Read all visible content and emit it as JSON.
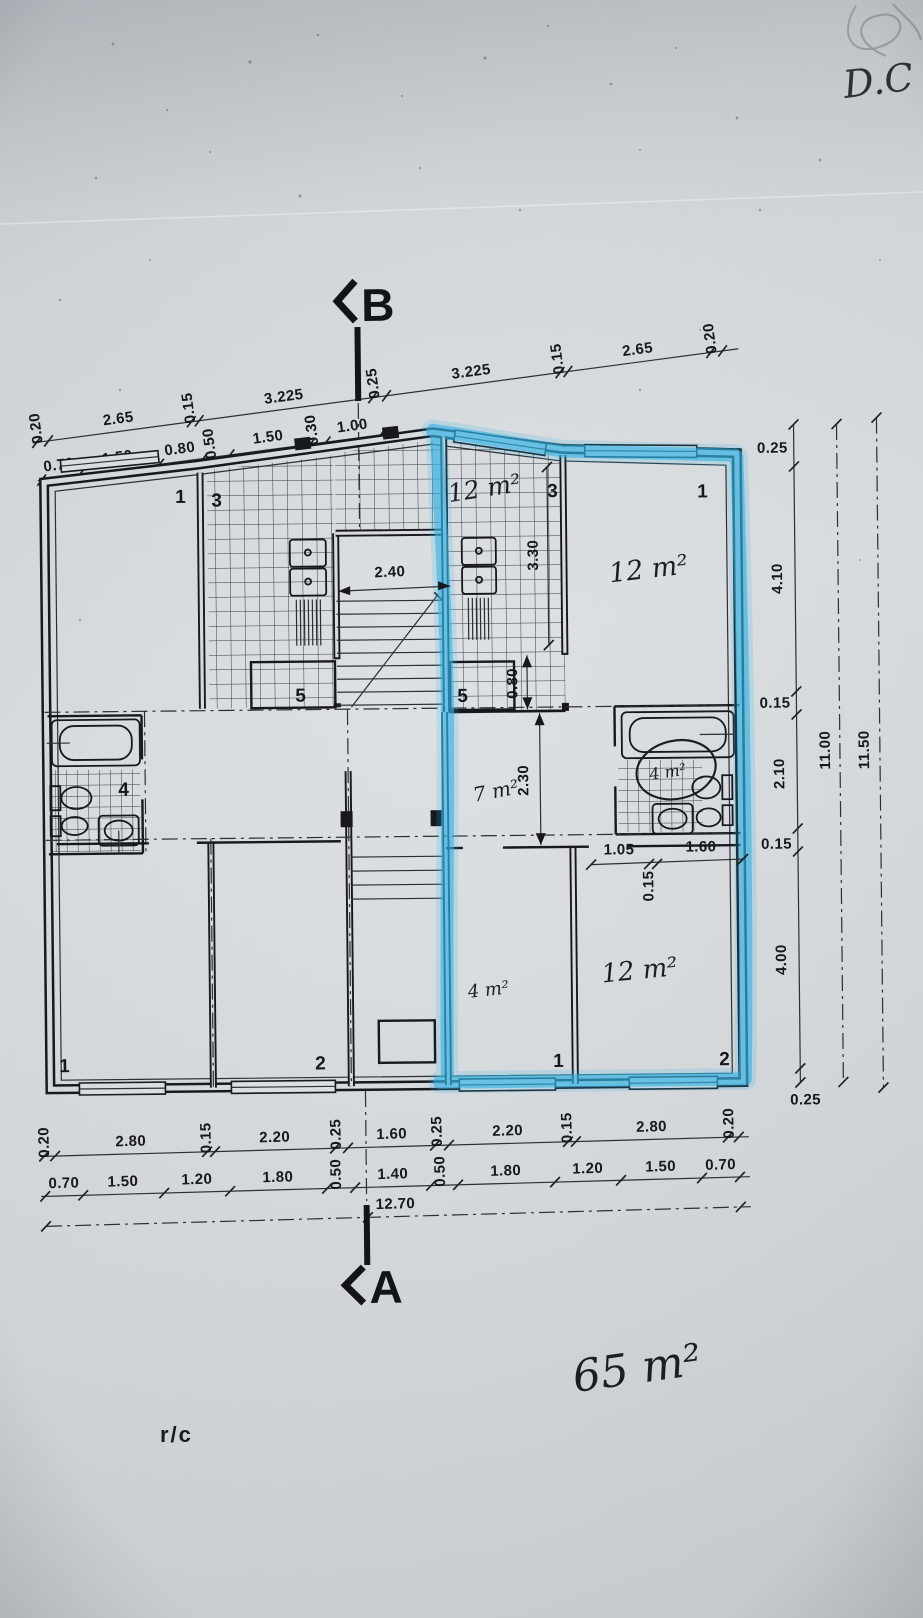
{
  "document": {
    "corner_note": "D.C",
    "floor_label": "r/c",
    "total_area_note": "65 m²"
  },
  "section_markers": {
    "top": "B",
    "bottom": "A"
  },
  "dimensions": {
    "top_row1": [
      "0.20",
      "2.65",
      "0.15",
      "3.225",
      "0.25",
      "3.225",
      "0.15",
      "2.65",
      "0.20"
    ],
    "top_row2": [
      "0.70",
      "1.50",
      "0.80",
      "0.50",
      "1.50",
      "0.30",
      "1.00"
    ],
    "bottom_row1": [
      "0.20",
      "2.80",
      "0.15",
      "2.20",
      "0.25",
      "1.60",
      "0.25",
      "2.20",
      "0.15",
      "2.80",
      "0.20"
    ],
    "bottom_row2": [
      "0.70",
      "1.50",
      "1.20",
      "1.80",
      "0.50",
      "1.40",
      "0.50",
      "1.80",
      "1.20",
      "1.50",
      "0.70"
    ],
    "bottom_total": "12.70",
    "right_chain": [
      "0.25",
      "4.10",
      "0.15",
      "2.10",
      "0.15",
      "4.00",
      "0.25"
    ],
    "right_total_inner": "11.00",
    "right_total_outer": "11.50",
    "stair_width": "2.40",
    "kitchen_length": "3.30",
    "kitchen_door": "0.80",
    "hall_depth": "2.30",
    "wall_chain": [
      "1.05",
      "0.15",
      "1.60"
    ]
  },
  "room_areas": {
    "kitchen": "12 m²",
    "bedroom_top": "12 m²",
    "hall": "7 m²",
    "bathroom": "4 m²",
    "bedroom_small": "4 m²",
    "bedroom_bottom": "12 m²"
  },
  "room_numbers": {
    "top_left": "1",
    "kitchen_left": "3",
    "kitchen_right": "3",
    "top_right": "1",
    "store_left": "5",
    "store_right": "5",
    "bath_left": "4",
    "bottom_left_a": "1",
    "bottom_left_b": "2",
    "bottom_right_a": "1",
    "bottom_right_b": "2"
  },
  "colors": {
    "highlighter": "#31b4e6",
    "ink": "#15181d",
    "paper": "#d8dcdf"
  }
}
